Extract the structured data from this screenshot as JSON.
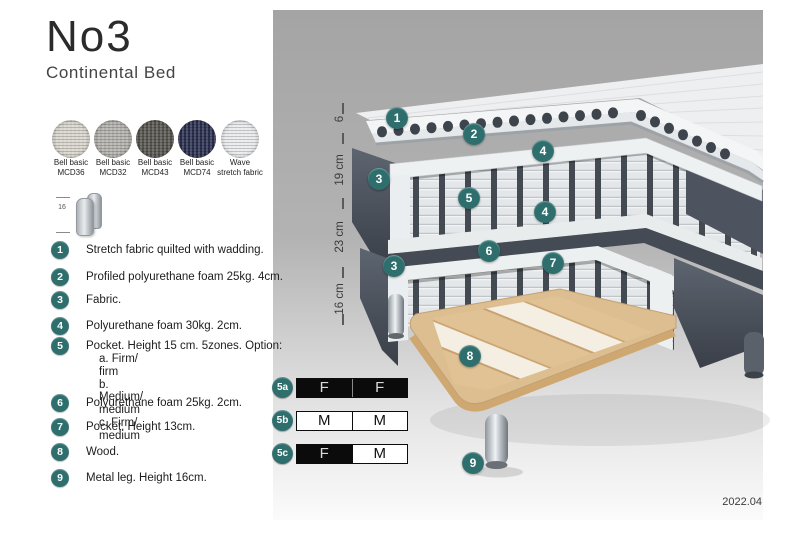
{
  "header": {
    "title": "No3",
    "subtitle": "Continental Bed"
  },
  "swatches": [
    {
      "name": "Bell basic",
      "code": "MCD36",
      "color": "#d9d6cd"
    },
    {
      "name": "Bell basic",
      "code": "MCD32",
      "color": "#b3b1ac"
    },
    {
      "name": "Bell basic",
      "code": "MCD43",
      "color": "#57564f"
    },
    {
      "name": "Bell basic",
      "code": "MCD74",
      "color": "#2c3050"
    },
    {
      "name": "Wave",
      "code": "stretch fabric",
      "color": "#e9ebed"
    }
  ],
  "leg_icon": {
    "dim_label": "16"
  },
  "legend": {
    "items": [
      {
        "num": "1",
        "text": "Stretch fabric quilted with wadding."
      },
      {
        "num": "2",
        "text": "Profiled polyurethane foam 25kg. 4cm."
      },
      {
        "num": "3",
        "text": "Fabric."
      },
      {
        "num": "4",
        "text": "Polyurethane foam 30kg. 2cm."
      },
      {
        "num": "5",
        "text": "Pocket. Height 15 cm. 5zones. Option:",
        "options": [
          "a. Firm/ firm",
          "b. Medium/ medium",
          "c. Firm/ medium"
        ]
      },
      {
        "num": "6",
        "text": "Polyurethane foam 25kg. 2cm."
      },
      {
        "num": "7",
        "text": "Pocket. Height 13cm."
      },
      {
        "num": "8",
        "text": "Wood."
      },
      {
        "num": "9",
        "text": "Metal leg. Height 16cm."
      }
    ]
  },
  "diagram": {
    "dimensions": [
      "6",
      "19 cm",
      "23 cm",
      "16 cm"
    ],
    "callouts": [
      {
        "label": "1",
        "x": 397,
        "y": 118
      },
      {
        "label": "2",
        "x": 474,
        "y": 134
      },
      {
        "label": "4",
        "x": 543,
        "y": 151
      },
      {
        "label": "3",
        "x": 379,
        "y": 179
      },
      {
        "label": "5",
        "x": 469,
        "y": 198
      },
      {
        "label": "4",
        "x": 545,
        "y": 212
      },
      {
        "label": "6",
        "x": 489,
        "y": 251
      },
      {
        "label": "7",
        "x": 553,
        "y": 263
      },
      {
        "label": "3",
        "x": 394,
        "y": 266
      },
      {
        "label": "8",
        "x": 470,
        "y": 356
      },
      {
        "label": "9",
        "x": 473,
        "y": 463
      }
    ],
    "firmness": {
      "rows": [
        {
          "label": "5a",
          "cells": [
            {
              "text": "F",
              "filled": true
            },
            {
              "text": "F",
              "filled": true
            }
          ]
        },
        {
          "label": "5b",
          "cells": [
            {
              "text": "M",
              "filled": false
            },
            {
              "text": "M",
              "filled": false
            }
          ]
        },
        {
          "label": "5c",
          "cells": [
            {
              "text": "F",
              "filled": true
            },
            {
              "text": "M",
              "filled": false
            }
          ]
        }
      ]
    },
    "version": "2022.04"
  },
  "colors": {
    "accent_teal": "#2e6f6e",
    "fabric_dark": "#4d545f",
    "wood": "#dcbe90"
  }
}
